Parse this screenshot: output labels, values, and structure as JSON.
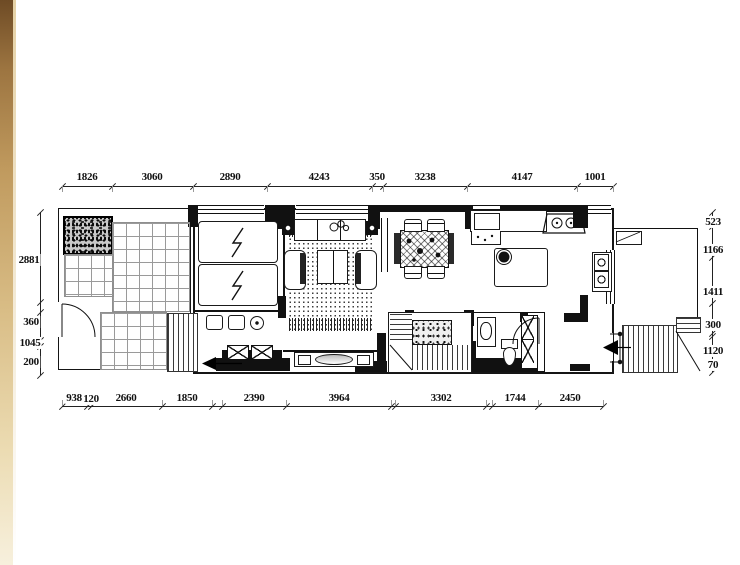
{
  "drawing": {
    "type": "residential floor plan",
    "units": "mm",
    "line_color": "#111111",
    "tile_line_color": "#9a9a9a",
    "frame_edge_color": "#a9814d"
  },
  "dimensions": {
    "top": [
      "1826",
      "3060",
      "2890",
      "4243",
      "350",
      "3238",
      "4147",
      "1001"
    ],
    "bottom": [
      "938",
      "120",
      "2660",
      "1850",
      "2390",
      "3964",
      "3302",
      "1744",
      "2450"
    ],
    "left": [
      "2881",
      "360",
      "1045",
      "200"
    ],
    "right": [
      "523",
      "1166",
      "1411",
      "300",
      "1120",
      "70"
    ]
  },
  "icons": {
    "lightning": "zigzag bolt glyph on equipment panels",
    "entry_arrow": "solid left-pointing triangle",
    "stove": "trapezoid with two burners",
    "sink": "twin basins with faucet circles"
  }
}
